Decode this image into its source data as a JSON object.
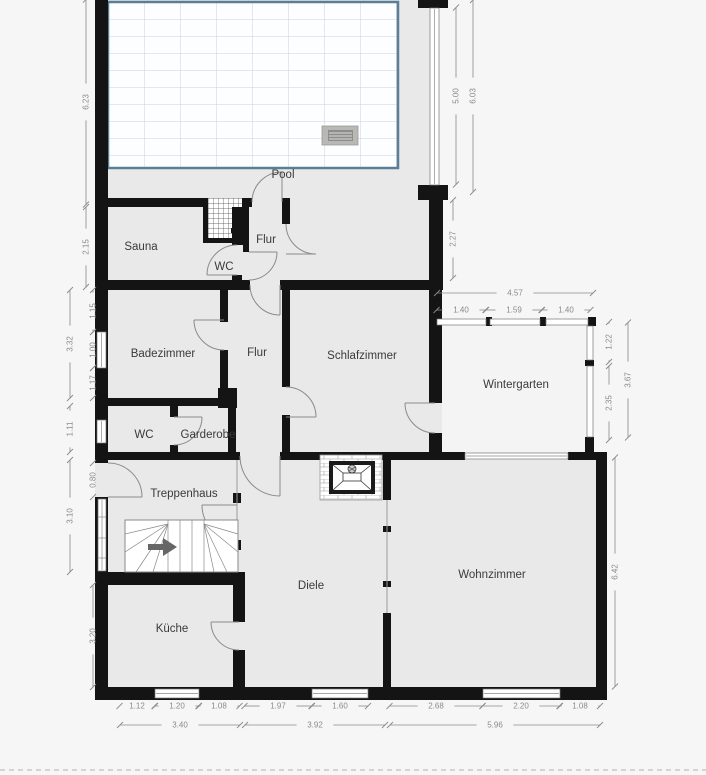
{
  "meta": {
    "type": "floor-plan",
    "unit": "m"
  },
  "colors": {
    "outside": "#f6f6f6",
    "floor": "#e9e9e9",
    "wall": "#141414",
    "pool_border": "#5b7e97",
    "pool_grid": "#c6d2dc",
    "dimension": "#8a8a8a",
    "room_label": "#3a3a3a"
  },
  "rooms": [
    {
      "label": "Pool",
      "x": 283,
      "y": 178
    },
    {
      "label": "Sauna",
      "x": 141,
      "y": 250
    },
    {
      "label": "Flur",
      "x": 266,
      "y": 243
    },
    {
      "label": "WC",
      "x": 224,
      "y": 270
    },
    {
      "label": "Badezimmer",
      "x": 163,
      "y": 357
    },
    {
      "label": "Flur",
      "x": 257,
      "y": 356
    },
    {
      "label": "Schlafzimmer",
      "x": 362,
      "y": 359
    },
    {
      "label": "Wintergarten",
      "x": 516,
      "y": 388
    },
    {
      "label": "WC",
      "x": 144,
      "y": 438
    },
    {
      "label": "Garderobe",
      "x": 208,
      "y": 438
    },
    {
      "label": "Treppenhaus",
      "x": 184,
      "y": 497
    },
    {
      "label": "Diele",
      "x": 311,
      "y": 589
    },
    {
      "label": "Wohnzimmer",
      "x": 492,
      "y": 578
    },
    {
      "label": "Küche",
      "x": 172,
      "y": 632
    }
  ],
  "dimensions": [
    {
      "v": "6.23",
      "x": 86,
      "y": 102,
      "o": "v",
      "len": 205
    },
    {
      "v": "2.15",
      "x": 86,
      "y": 247,
      "o": "v",
      "len": 80
    },
    {
      "v": "1.15",
      "x": 93,
      "y": 311,
      "o": "v",
      "len": 42
    },
    {
      "v": "1.00",
      "x": 93,
      "y": 350,
      "o": "v",
      "len": 36
    },
    {
      "v": "1.17",
      "x": 93,
      "y": 383,
      "o": "v",
      "len": 30
    },
    {
      "v": "3.32",
      "x": 70,
      "y": 344,
      "o": "v",
      "len": 108
    },
    {
      "v": "1.11",
      "x": 70,
      "y": 429,
      "o": "v",
      "len": 46
    },
    {
      "v": "0.80",
      "x": 93,
      "y": 480,
      "o": "v",
      "len": 34
    },
    {
      "v": "3.10",
      "x": 70,
      "y": 516,
      "o": "v",
      "len": 112
    },
    {
      "v": "3.20",
      "x": 93,
      "y": 636,
      "o": "v",
      "len": 102
    },
    {
      "v": "5.00",
      "x": 456,
      "y": 96,
      "o": "v",
      "len": 177
    },
    {
      "v": "6.03",
      "x": 473,
      "y": 96,
      "o": "v",
      "len": 192
    },
    {
      "v": "2.27",
      "x": 453,
      "y": 239,
      "o": "v",
      "len": 78
    },
    {
      "v": "4.57",
      "x": 515,
      "y": 293,
      "o": "h",
      "len": 156
    },
    {
      "v": "1.40",
      "x": 461,
      "y": 310,
      "o": "h",
      "len": 49
    },
    {
      "v": "1.59",
      "x": 514,
      "y": 310,
      "o": "h",
      "len": 56
    },
    {
      "v": "1.40",
      "x": 566,
      "y": 310,
      "o": "h",
      "len": 49
    },
    {
      "v": "1.22",
      "x": 609,
      "y": 342,
      "o": "v",
      "len": 40
    },
    {
      "v": "2.35",
      "x": 609,
      "y": 403,
      "o": "v",
      "len": 74
    },
    {
      "v": "3.67",
      "x": 628,
      "y": 380,
      "o": "v",
      "len": 115
    },
    {
      "v": "6.42",
      "x": 615,
      "y": 572,
      "o": "v",
      "len": 229
    },
    {
      "v": "1.12",
      "x": 137,
      "y": 706,
      "o": "h",
      "len": 35
    },
    {
      "v": "1.20",
      "x": 177,
      "y": 706,
      "o": "h",
      "len": 44
    },
    {
      "v": "1.08",
      "x": 219,
      "y": 706,
      "o": "h",
      "len": 41
    },
    {
      "v": "1.97",
      "x": 278,
      "y": 706,
      "o": "h",
      "len": 67
    },
    {
      "v": "1.60",
      "x": 340,
      "y": 706,
      "o": "h",
      "len": 56
    },
    {
      "v": "2.68",
      "x": 436,
      "y": 706,
      "o": "h",
      "len": 93
    },
    {
      "v": "2.20",
      "x": 521,
      "y": 706,
      "o": "h",
      "len": 77
    },
    {
      "v": "1.08",
      "x": 580,
      "y": 706,
      "o": "h",
      "len": 40
    }
  ],
  "dimension_totals_bottom": [
    {
      "v": "3.40",
      "x": 180,
      "y": 725,
      "o": "h",
      "len": 120
    },
    {
      "v": "3.92",
      "x": 315,
      "y": 725,
      "o": "h",
      "len": 140
    },
    {
      "v": "5.96",
      "x": 495,
      "y": 725,
      "o": "h",
      "len": 210
    }
  ]
}
